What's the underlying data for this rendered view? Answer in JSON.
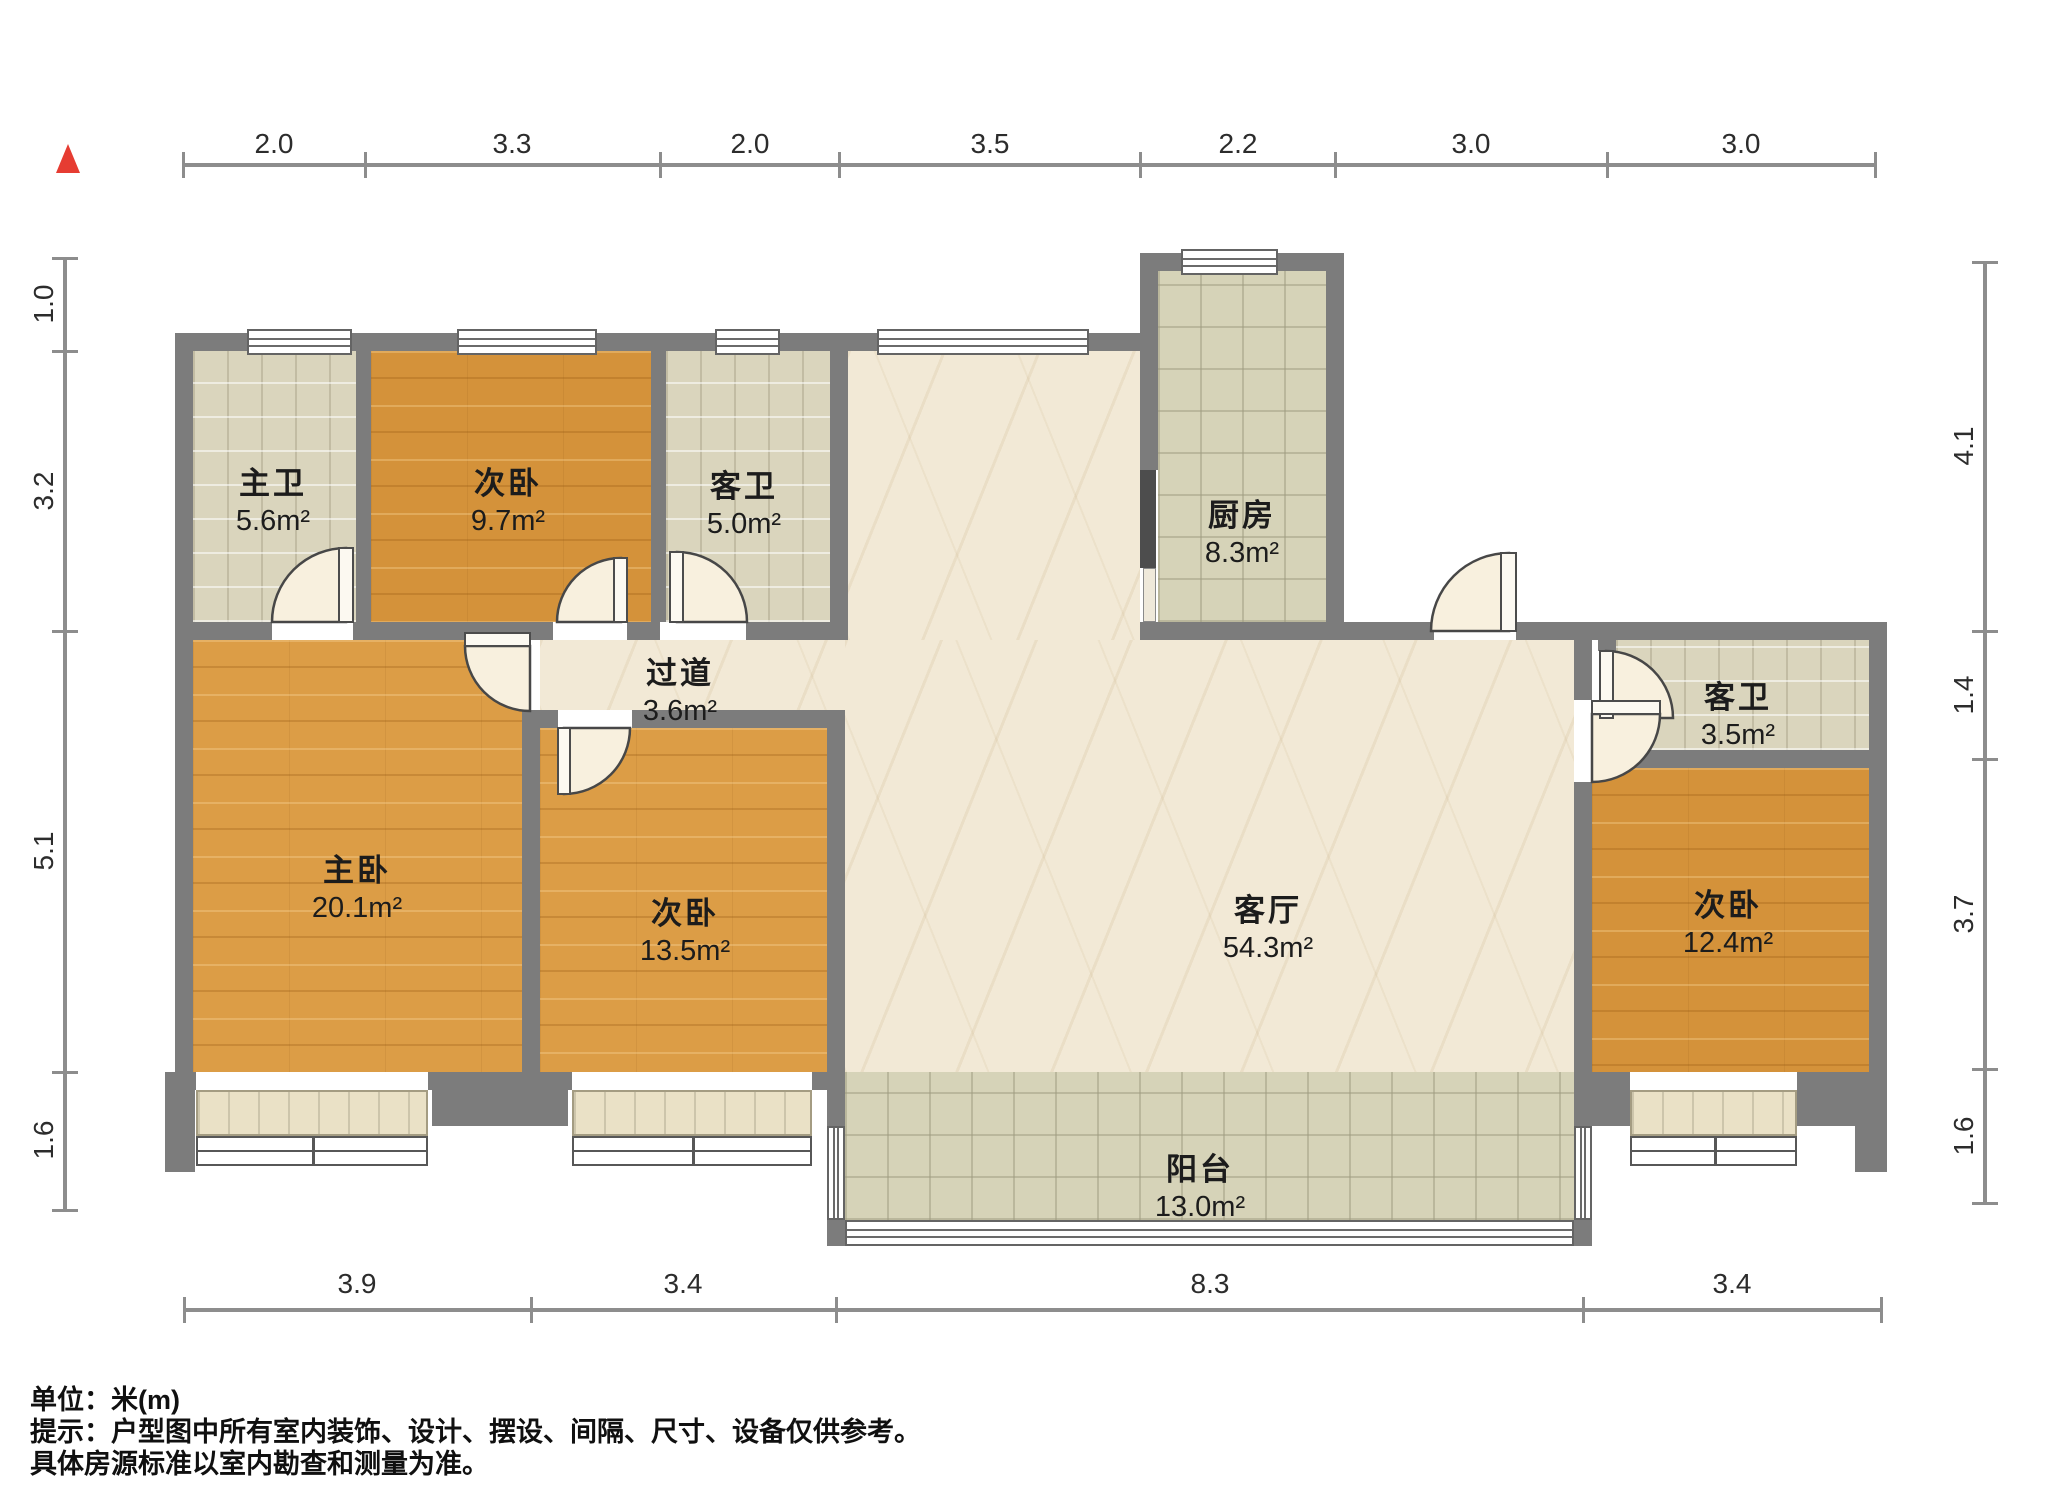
{
  "title": "户型图",
  "compass": {
    "icon": "north-arrow",
    "color": "#e63c32"
  },
  "rooms": [
    {
      "id": "master-bath",
      "name": "主卫",
      "area": "5.6m²",
      "floor": "tile"
    },
    {
      "id": "bedroom-top",
      "name": "次卧",
      "area": "9.7m²",
      "floor": "wood"
    },
    {
      "id": "guest-bath-top",
      "name": "客卫",
      "area": "5.0m²",
      "floor": "tile"
    },
    {
      "id": "kitchen",
      "name": "厨房",
      "area": "8.3m²",
      "floor": "tile"
    },
    {
      "id": "corridor",
      "name": "过道",
      "area": "3.6m²",
      "floor": "marble"
    },
    {
      "id": "master-bedroom",
      "name": "主卧",
      "area": "20.1m²",
      "floor": "wood"
    },
    {
      "id": "bedroom-mid",
      "name": "次卧",
      "area": "13.5m²",
      "floor": "wood"
    },
    {
      "id": "living-room",
      "name": "客厅",
      "area": "54.3m²",
      "floor": "marble"
    },
    {
      "id": "guest-bath-right",
      "name": "客卫",
      "area": "3.5m²",
      "floor": "tile"
    },
    {
      "id": "bedroom-right",
      "name": "次卧",
      "area": "12.4m²",
      "floor": "wood"
    },
    {
      "id": "balcony",
      "name": "阳台",
      "area": "13.0m²",
      "floor": "tile"
    }
  ],
  "dims": {
    "top": [
      "2.0",
      "3.3",
      "2.0",
      "3.5",
      "2.2",
      "3.0",
      "3.0"
    ],
    "left": [
      "1.0",
      "3.2",
      "5.1",
      "1.6"
    ],
    "right": [
      "4.1",
      "1.4",
      "3.7",
      "1.6"
    ],
    "bottom": [
      "3.9",
      "3.4",
      "8.3",
      "3.4"
    ]
  },
  "footer": {
    "unit_label": "单位：米(m)",
    "note_line1": "提示：户型图中所有室内装饰、设计、摆设、间隔、尺寸、设备仅供参考。",
    "note_line2": "具体房源标准以室内勘查和测量为准。"
  }
}
